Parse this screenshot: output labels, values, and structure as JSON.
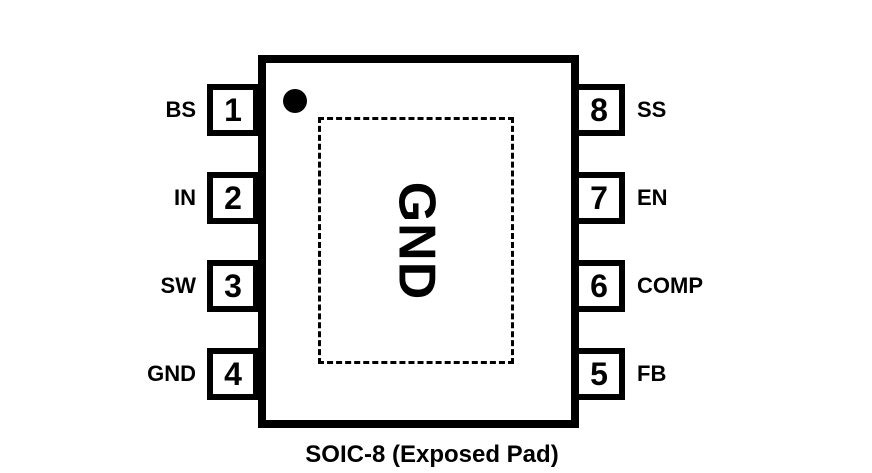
{
  "diagram": {
    "caption": "SOIC-8 (Exposed Pad)",
    "exposed_pad_label": "GND",
    "pins_left": [
      {
        "number": "1",
        "label": "BS"
      },
      {
        "number": "2",
        "label": "IN"
      },
      {
        "number": "3",
        "label": "SW"
      },
      {
        "number": "4",
        "label": "GND"
      }
    ],
    "pins_right": [
      {
        "number": "8",
        "label": "SS"
      },
      {
        "number": "7",
        "label": "EN"
      },
      {
        "number": "6",
        "label": "COMP"
      },
      {
        "number": "5",
        "label": "FB"
      }
    ],
    "colors": {
      "line": "#000000",
      "background": "#ffffff"
    }
  }
}
